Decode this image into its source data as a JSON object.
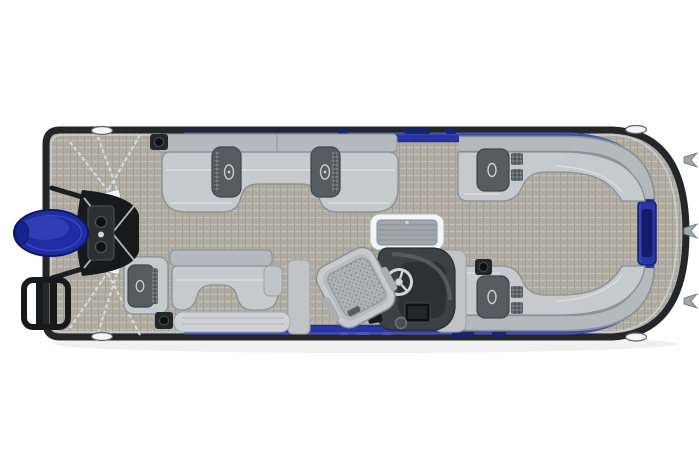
{
  "colors": {
    "background": "#ffffff",
    "rub_rail": "#24272a",
    "hull_trim": "#cfd2d4",
    "fence_blue": "#2937a6",
    "fence_dark": "#18216e",
    "fence_light": "#4c58bd",
    "gate_window": "#131c6b",
    "carpet_base": "#b1ada5",
    "carpet_light": "#c5c1b9",
    "carpet_dark": "#9c988f",
    "seat_base": "#c6cacd",
    "seat_back": "#b4b9bd",
    "seat_outline": "#8b9196",
    "seat_seam": "#dde0e2",
    "console_dark": "#575c61",
    "console_outline": "#3f4449",
    "badge_chrome": "#ccd0d3",
    "perf_base": "#62676c",
    "perf_dot": "#9aa0a4",
    "chair_base": "#adb2b6",
    "chair_dot": "#82888d",
    "helm_surround": "#c0c4c7",
    "helm_body": "#3d4044",
    "helm_panel": "#2e3134",
    "chrome": "#d2d6d9",
    "black_part": "#17191b",
    "metal_plate": "#2c2f33",
    "motor_blue": "#202ca3",
    "motor_dark": "#101868",
    "motor_light": "#3442b6",
    "table_frame": "#f2f4f5",
    "table_top": "#a0a7ac",
    "table_line": "#878e93",
    "cleat_white": "#f2f4f5",
    "chain": "#d9dbdd",
    "speaker_box": "#24272a",
    "speaker_cone": "#0f1113",
    "hook_metal": "#9fa5aa",
    "bench_metal": "#ced2d5",
    "knob_gray": "#4a4e53"
  }
}
